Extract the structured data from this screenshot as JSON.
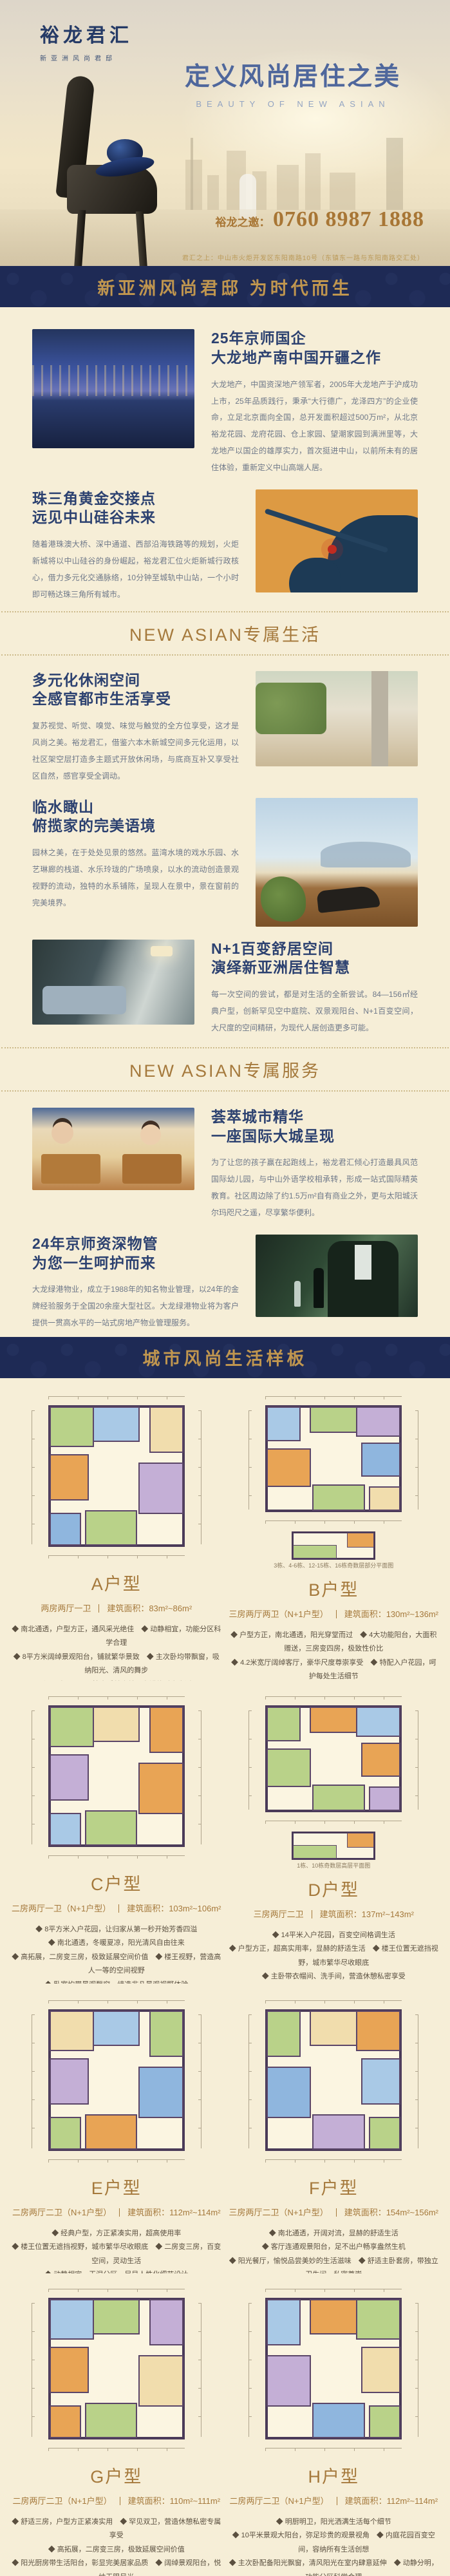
{
  "hero": {
    "logo_title": "裕龙君汇",
    "logo_sub": "新亚洲风尚君邸",
    "title": "定义风尚居住之美",
    "subtitle": "BEAUTY OF NEW ASIAN",
    "phone_label": "裕龙之邀：",
    "phone": "0760 8987 1888",
    "address": "君汇之上：中山市火炬开发区东阳南路10号（东镇东一路与东阳南路交汇处）"
  },
  "banner1": {
    "text": "新亚洲风尚君邸 为时代而生"
  },
  "banner2": {
    "text": "城市风尚生活样板"
  },
  "dividers": {
    "life": "NEW ASIAN专属生活",
    "service": "NEW ASIAN专属服务"
  },
  "sections": [
    {
      "title1": "25年京师国企",
      "title2": "大龙地产南中国开疆之作",
      "body": "大龙地产，中国资深地产领军者，2005年大龙地产于沪成功上市，25年品质践行，秉承“大行德广，龙泽四方”的企业使命，立足北京面向全国，总开发面积超过500万m²，从北京裕龙花园、龙府花园、仓上家园、望潮家园到满洲里等，大龙地产以国企的雄厚实力，首次挺进中山，以前所未有的居住体验，重新定义中山高端人居。"
    },
    {
      "title1": "珠三角黄金交接点",
      "title2": "远见中山硅谷未来",
      "body": "随着港珠澳大桥、深中通道、西部沿海铁路等的规划，火炬新城将以中山硅谷的身份崛起，裕龙君汇位火炬新城行政核心，借力多元化交通脉络，10分钟至城轨中山站，一个小时即可畅达珠三角所有城市。"
    },
    {
      "title1": "多元化休闲空间",
      "title2": "全感官都市生活享受",
      "body": "复苏视觉、听觉、嗅觉、味觉与触觉的全方位享受，这才是风尚之美。裕龙君汇，借鉴六本木新城空间多元化运用，以社区架空层打造多主题式开放休闲场，与底商互补又享受社区自然，感官享受全调动。"
    },
    {
      "title1": "临水瞰山",
      "title2": "俯揽家的完美语境",
      "body": "园林之美，在于处处见景的悠然。蓝湾水境的戏水乐园、水艺琳廊的栈道、水乐玲珑的广场喷泉，以水的流动创造景观视野的流动，独特的水系铺陈，呈现人在景中，景在窗前的完美境界。"
    },
    {
      "title1": "N+1百变舒居空间",
      "title2": "演绎新亚洲居住智慧",
      "body": "每一次空间的尝试，都是对生活的全新尝试。84—156㎡经典户型，创新罕见空中庭院、双景观阳台、N+1百变空间，大尺度的空间精研，为现代人居创造更多可能。"
    },
    {
      "title1": "荟萃城市精华",
      "title2": "一座国际大城呈现",
      "body": "为了让您的孩子赢在起跑线上，裕龙君汇倾心打造最具风范国际幼儿园，与中山外语学校相承转，形成一站式国际精英教育。社区周边除了约1.5万m²自有商业之外，更与太阳城沃尔玛咫尺之遥，尽享繁华便利。"
    },
    {
      "title1": "24年京师资深物管",
      "title2": "为您一生呵护而来",
      "body": "大龙绿港物业，成立于1988年的知名物业管理，以24年的金牌经验服务于全国20余座大型社区。大龙绿港物业将为客户提供一贯高水平的一站式房地产物业管理服务。"
    }
  ],
  "floorplans": [
    {
      "name": "A户型",
      "layout": "两房两厅一卫",
      "area": "建筑面积：83m²~86m²",
      "bullets": [
        "◆ 南北通透，户型方正，通风采光绝佳　◆ 动静相宜，功能分区科学合理",
        "◆ 8平方米阔绰景观阳台，铺就繁华景致　◆ 主次卧均带飘窗，吸纳阳光、清风的舞步",
        "◆ 品味明阳，尽情享受美食美景交错的时尚生活"
      ]
    },
    {
      "name": "B户型",
      "layout": "三房两厅两卫（N+1户型）",
      "area": "建筑面积：130m²~136m²",
      "note": "3栋、4-6栋、12-15栋、16栋奇数层部分平面图",
      "bullets": [
        "◆ 户型方正，南北通透，阳光穿堂而过　◆ 4大功能阳台，大面积赠送，三房变四房，极致性价比",
        "◆ 4.2米宽厅阔绰客厅，豪华尺度尊崇享受　◆ 特配入户花园，呵护每处生活细节",
        "◆ 卧室均带景观飘窗，营造非凡景观视野体验"
      ]
    },
    {
      "name": "C户型",
      "layout": "二房两厅一卫（N+1户型）",
      "area": "建筑面积：103m²~106m²",
      "bullets": [
        "◆ 8平方米入户花园，让归家从第一秒开始芳香四溢",
        "◆ 南北通透，冬暖夏凉，阳光清风自由往来",
        "◆ 高拓展，二房变三房，极致延展空间价值　◆ 楼王视野，营造高人一等的空间视野",
        "◆ 卧室均带景观飘窗，缔造非凡景观视野体验"
      ]
    },
    {
      "name": "D户型",
      "layout": "三房两厅二卫",
      "area": "建筑面积：137m²~143m²",
      "note": "1栋、10栋奇数层高层平面图",
      "bullets": [
        "◆ 14平米入户花园，百变空间格调生活",
        "◆ 户型方正，超高实用率，显赫的舒适生活　◆ 楼王位置无遮挡视野，城市繁华尽收眼底",
        "◆ 主卧带衣帽间、洗手间，营造休憩私密享受",
        "◆ 动静相宜，免噪音干扰，给予生活无限关怀"
      ]
    },
    {
      "name": "E户型",
      "layout": "二房两厅二卫（N+1户型）",
      "area": "建筑面积：112m²~114m²",
      "bullets": [
        "◆ 经典户型，方正紧凑实用，超高使用率",
        "◆ 楼王位置无遮挡视野，城市繁华尽收眼底　◆ 二房变三房，百变空间，灵动生活",
        "◆ 动静相宜、干湿分区，尽显人性化细节设计",
        "◆ 观景阳台，休憩中饱览景观园林无限美景"
      ]
    },
    {
      "name": "F户型",
      "layout": "三房两厅二卫（N+1户型）",
      "area": "建筑面积：154m²~156m²",
      "bullets": [
        "◆ 南北通透，开阔对流，显赫的舒适生活",
        "◆ 客厅连通观景阳台，足不出户畅享盎然生机",
        "◆ 阳光餐厅，愉悦品尝美妙的生活滋味　◆ 舒适主卧套房，带独立卫生间，私密尊崇",
        "◆ 动静相宜，极致空间科学合理"
      ]
    },
    {
      "name": "G户型",
      "layout": "二房两厅二卫（N+1户型）",
      "area": "建筑面积：110m²~111m²",
      "bullets": [
        "◆ 舒适三房，户型方正紧凑实用　◆ 罕见双卫，营造休憩私密专属享受",
        "◆ 高拓展，二房变三房，极致延展空间价值",
        "◆ 阳光厨房带生活阳台，彰显完美居家品质　◆ 阔绰景观阳台，悦纳无限风光"
      ]
    },
    {
      "name": "H户型",
      "layout": "二房两厅二卫（N+1户型）",
      "area": "建筑面积：112m²~114m²",
      "bullets": [
        "◆ 明厨明卫，阳光洒满生活每个细节",
        "◆ 10平米景观大阳台，弥足珍贵的观景视角　◆ 内庭花园百变空间，容纳所有生活创想",
        "◆ 主次卧配备阳光飘窗，清风阳光在室内肆意延伸　◆ 动静分明，功能分区科学合理"
      ]
    }
  ],
  "footer": {
    "text": "更多精美户型欢迎您来销售中心体验垂询"
  }
}
